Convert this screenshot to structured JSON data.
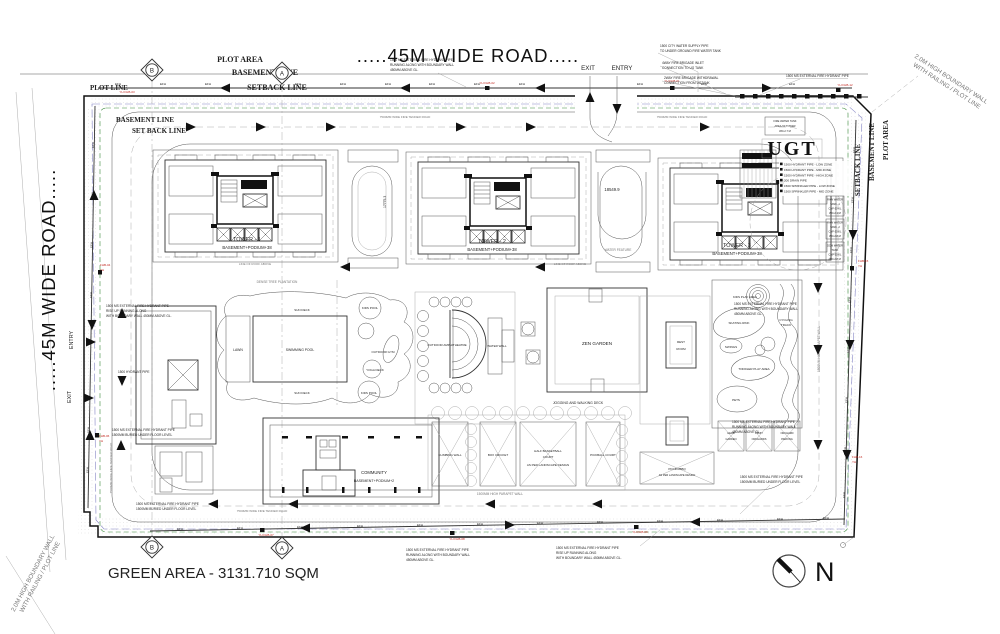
{
  "colors": {
    "line": "#333333",
    "red_label": "#c22a22",
    "green_dash": "#3d8b3d",
    "blue_dash": "#8585c5"
  },
  "roads": {
    "top": ".....45M WIDE ROAD.....",
    "left": ".....45M WIDE ROAD.....",
    "fire_tender": "7500MM WIDE FIRE TENDER ROAD"
  },
  "gates": {
    "exit": "EXIT",
    "entry": "ENTRY"
  },
  "markers": {
    "a": "A",
    "b": "B"
  },
  "boundary": {
    "plot_line": "PLOT LINE",
    "plot_area": "PLOT AREA",
    "basement_line": "BASEMENT LINE",
    "setback_line": "SETBACK LINE",
    "set_back_line": "SET BACK LINE",
    "wall_note_1": "2.0M HIGH BOUNDARY WALL",
    "wall_note_2": "WITH RAILING / PLOT LINE"
  },
  "towers": [
    {
      "name": "TOWER - 1",
      "sub": "BASEMENT+PODIUM+38"
    },
    {
      "name": "TOWER - 2",
      "sub": "BASEMENT+PODIUM+38"
    },
    {
      "name": "TOWER - 3",
      "sub": "BASEMENT+PODIUM+38"
    }
  ],
  "tower_area": {
    "water_feature": "WATER FEATURE",
    "line_of_roof": "LINE OF ROOF ABOVE",
    "dim_1": "17775.3",
    "dim_2": "18549.9",
    "ugt": "UGT"
  },
  "ugt_pipes": [
    "1500 HYDRANT PIPE - LOW ZONE",
    "1500 HYDRANT PIPE - MID ZONE",
    "1500 HYDRANT PIPE - HIGH ZONE",
    "200 DRAIN PIPE",
    "1500 SPRINKLER PIPE - LOW ZONE",
    "1500 SPRINKLER PIPE - MID ZONE"
  ],
  "tanks": [
    {
      "lines": [
        "FIRE WATER TANK",
        "AREA-50 TOWER",
        "WD-2.7 M"
      ]
    },
    {
      "lines": [
        "RAW WATER",
        "TANK -1",
        "CAP-50 KL",
        "WD-2.1 M"
      ]
    },
    {
      "lines": [
        "RAW WATER",
        "TANK -2",
        "CAP-50 KL",
        "WD-2.8 M"
      ]
    },
    {
      "lines": [
        "DOM WATER",
        "TANK",
        "CAP-50 KL",
        "WD-2.8 M"
      ]
    }
  ],
  "amenities": {
    "dense_tree": "DENSE TREE PLANTATION",
    "sun_deck": "SUN DECK",
    "lawn": "LAWN",
    "swimming_pool": "SWIMMING POOL",
    "kids_pool": "KIDS POOL",
    "outdoor_gym": "OUTDOOR GYM",
    "yoga_deck": "YOGA DECK",
    "amphitheatre": "OUTDOOR AMPHITHEATRE",
    "water_wall": "WATER WALL",
    "zen_garden": "ZEN GARDEN",
    "jogging": "JOGGING AND WALKING DECK",
    "rest_1": "REST",
    "rest_2": "ROOM",
    "kids_play": "KIDS PLAY AREA",
    "skating": "SKATING RINK",
    "cycling_1": "CYCLING",
    "cycling_2": "TRACK",
    "swings": "SWINGS",
    "toddler": "TODDLER PLAY AREA",
    "pets": "PETS"
  },
  "community": {
    "name": "COMMUNITY",
    "sub": "BASEMENT+PODIUM+2"
  },
  "sports": {
    "climbing": "CLIMBING WALL",
    "box_cricket": "BOX CRICKET",
    "basketball_1": "HALF BASKETBALL",
    "basketball_2": "COURT",
    "basketball_3": "AS PER LANDSCAPE DESIGN",
    "pickball": "PICKBALL COURT",
    "picnic_1": "PICNIC/BBQ",
    "picnic_2": "AS PER LANDSCAPE DESIGN",
    "herb_1": "HERB",
    "herb_2": "GARDEN",
    "fruit_1": "FRUIT",
    "fruit_2": "ORCHARDS",
    "orchard_1": "ORCHARD",
    "orchard_2": "PARKING"
  },
  "walls": {
    "parapet": "1500MM HIGH PARAPET WALL"
  },
  "pipes": {
    "efh": "EFH"
  },
  "fhb": {
    "f01": "YH FHB-01",
    "f02": "YH FHB-02",
    "f03": "YH FHB-03",
    "f04": "FHB-04",
    "f06": "FHB-06",
    "f07": "YH FHB-07",
    "f08": "YH FHB-08",
    "f09": "YH FHB-09",
    "f12": "YH FHB-12",
    "f15": "FHB-15",
    "f16": "FHB-16",
    "yh": "YH"
  },
  "notes": {
    "hydrant_along": [
      "1500 MS EXTERNAL FIRE HYDRANT PIPE",
      "RUNNING ALONG WITH BOUNDARY WALL",
      "450MM ABOVE GL."
    ],
    "city_water": [
      "1500 CITY WATER SUPPLY PIPE",
      "TO UNDER GROUND FIRE WATER TANK"
    ],
    "brigade_inlet": [
      "4WAY FIRE BRIGADE INLET",
      "CONNECTION TO UG TANK"
    ],
    "brigade_withdraw": [
      "2WAY FIRE BRIGADE WITHDRAWAL",
      "CONNECTION FROM UGTANK"
    ],
    "hydrant_pipe": [
      "1500 MS EXTERNAL FIRE HYDRANT PIPE"
    ],
    "rise_up": [
      "1500 MS EXTERNAL FIRE HYDRANT PIPE",
      "RISE UP RUNNING ALONG",
      "WITH BOUNDARY WALL 450MM ABOVE GL."
    ],
    "buried": [
      "1500 MS EXTERNAL FIRE HYDRANT PIPE",
      "1500MM BURIED UNDER FLOOR LEVEL"
    ],
    "hydrant_mid": [
      "1500 HYDRANT PIPE"
    ]
  },
  "footer": {
    "green_area": "GREEN AREA - 3131.710 SQM",
    "north": "N"
  }
}
